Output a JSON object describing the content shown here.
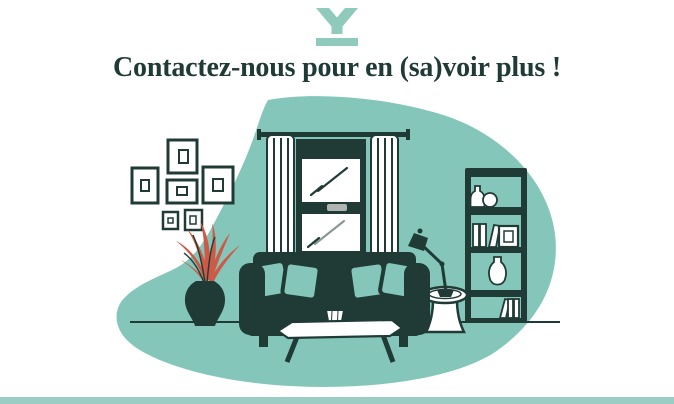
{
  "header": {
    "logo_icon": "y-monogram-logo",
    "title": "Contactez-nous pour en (sa)voir plus !"
  },
  "illustration": "living-room-scene",
  "colors": {
    "dark_green": "#203b36",
    "teal": "#84c7ba",
    "logo_teal": "#8fcabc",
    "bottom_bar_teal": "#9ccdc4",
    "plant_red": "#cc5a47",
    "window_handle_gray": "#b0b5b4",
    "background": "#ffffff"
  }
}
